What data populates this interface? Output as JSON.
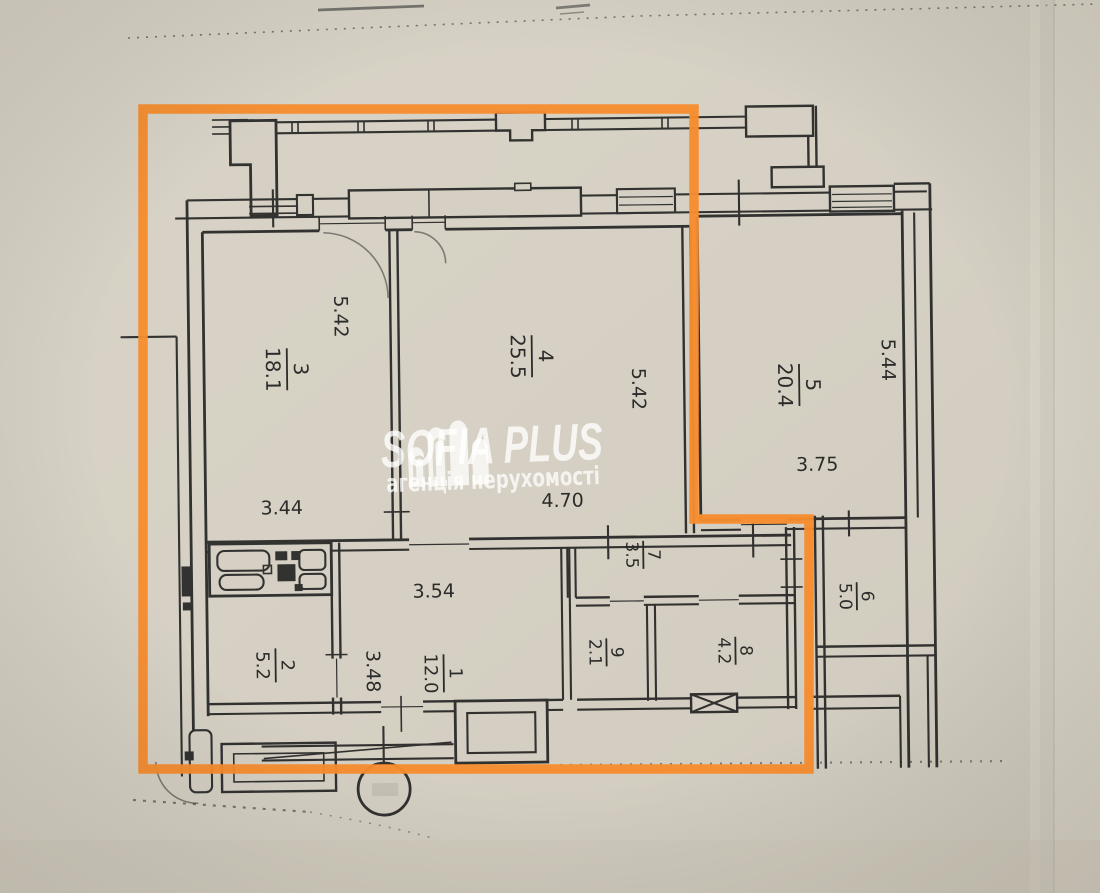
{
  "document": {
    "kind": "scanned apartment floor plan photo"
  },
  "watermark": {
    "brand": "SOFIA PLUS",
    "tagline": "агенція нерухомості"
  },
  "colors": {
    "highlight_outline": "#F78C2E",
    "paper": "#D6D1C4",
    "ink": "#262626",
    "watermark_text": "#FFFFFF"
  },
  "rooms": {
    "r1": {
      "number": "1",
      "area": "12.0"
    },
    "r2": {
      "number": "2",
      "area": "5.2"
    },
    "r3": {
      "number": "3",
      "area": "18.1"
    },
    "r4": {
      "number": "4",
      "area": "25.5"
    },
    "r5": {
      "number": "5",
      "area": "20.4"
    },
    "r6": {
      "number": "6",
      "area": "5.0"
    },
    "r7": {
      "number": "7",
      "area": "3.5"
    },
    "r8": {
      "number": "8",
      "area": "4.2"
    },
    "r9": {
      "number": "9",
      "area": "2.1"
    }
  },
  "dimensions": {
    "room3_height": "5.42",
    "room3_width": "3.44",
    "room4_height": "5.42",
    "room4_width": "4.70",
    "room5_height": "5.44",
    "room5_width": "3.75",
    "hall_width": "3.54",
    "hall_height": "3.48"
  }
}
